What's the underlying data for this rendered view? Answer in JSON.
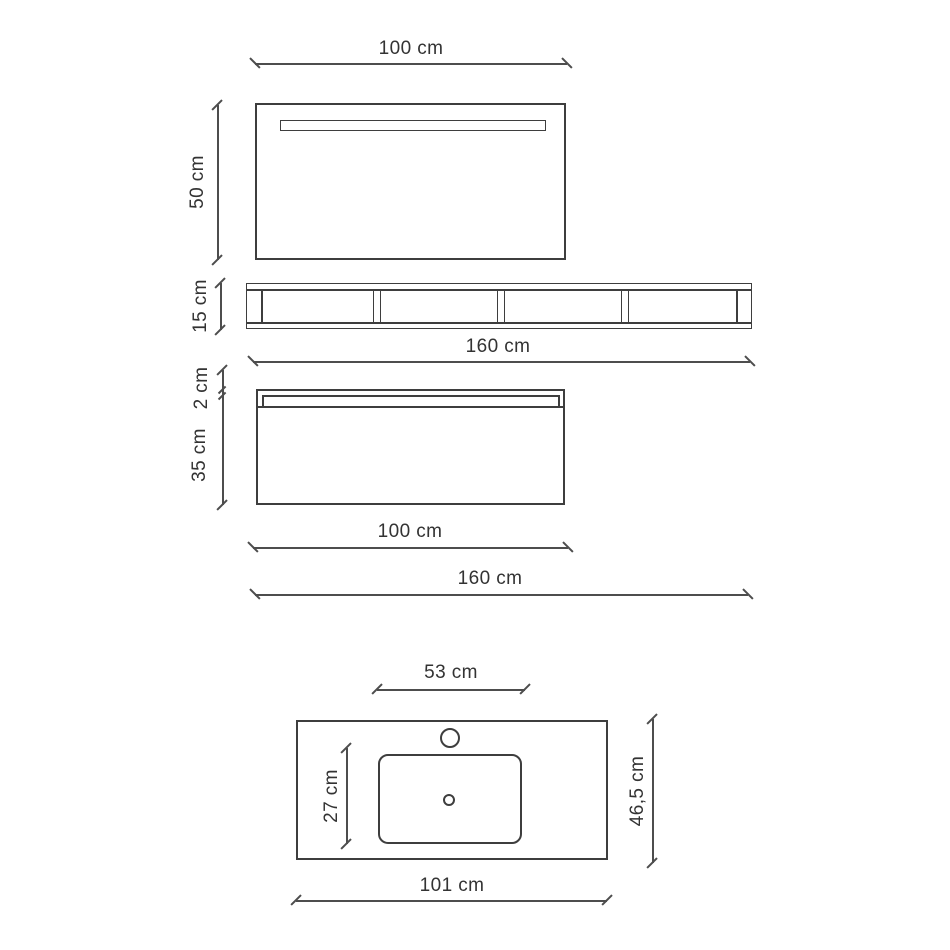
{
  "colors": {
    "line_color": "#3e3e3e",
    "dim_line_color": "#4d4d4d",
    "text_color": "#333333",
    "background": "#ffffff"
  },
  "dimensions": {
    "mirror_width": "100 cm",
    "mirror_height": "50 cm",
    "shelf_height": "15 cm",
    "shelf_width": "160 cm",
    "cabinet_top_thickness": "2 cm",
    "cabinet_height": "35 cm",
    "cabinet_width": "100 cm",
    "composition_width": "160 cm",
    "basin_width": "53 cm",
    "basin_depth": "27 cm",
    "countertop_depth": "46,5 cm",
    "countertop_width": "101 cm"
  },
  "shelf": {
    "compartments": 4
  }
}
